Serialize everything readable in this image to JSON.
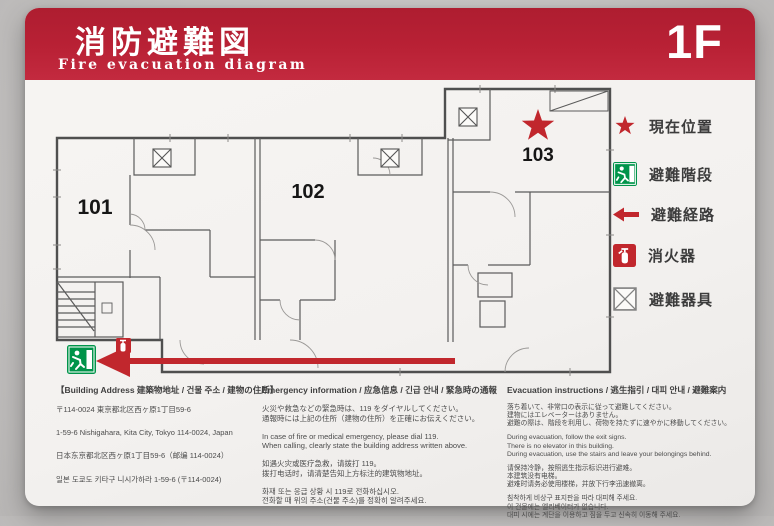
{
  "header": {
    "title_ja": "消防避難図",
    "title_en": "Fire evacuation diagram",
    "floor_label": "1F"
  },
  "floorplan": {
    "rooms": [
      {
        "label": "101"
      },
      {
        "label": "102"
      },
      {
        "label": "103"
      }
    ]
  },
  "legend": {
    "items": [
      {
        "icon": "current-location-star",
        "label": "現在位置"
      },
      {
        "icon": "evacuation-stairs",
        "label": "避難階段"
      },
      {
        "icon": "evacuation-route-arrow",
        "label": "避難経路"
      },
      {
        "icon": "fire-extinguisher",
        "label": "消火器"
      },
      {
        "icon": "evacuation-equipment",
        "label": "避難器具"
      }
    ]
  },
  "sections": {
    "building_address": {
      "heading": "【Building Address 建築物地址 / 건물 주소 / 建物の住所】",
      "lines": [
        "〒114-0024 東京都北区西ヶ原1丁目59-6",
        "1-59-6 Nishigahara, Kita City, Tokyo 114-0024, Japan",
        "日本东京都北区西ヶ原1丁目59-6（邮编 114-0024）",
        "일본 도쿄도 키타구 니시가하라 1-59-6 (〒114-0024)"
      ]
    },
    "emergency_information": {
      "heading": "Emergency information / 应急信息 / 긴급 안내 / 緊急時の通報",
      "paragraphs": [
        [
          "火災や救急などの緊急時は、119 をダイヤルしてください。",
          "通報時には上記の住所（建物の住所）を正確にお伝えください。"
        ],
        [
          "In case of fire or medical emergency, please dial 119.",
          "When calling, clearly state the building address written above."
        ],
        [
          "如遇火灾或医疗急救，请拨打 119。",
          "拨打电话时，请清楚告知上方标注的建筑物地址。"
        ],
        [
          "화재 또는 응급 상황 시 119로 전화하십시오.",
          "전화할 때 위의 주소(건물 주소)를 정확히 알려주세요."
        ]
      ]
    },
    "evacuation_instructions": {
      "heading": "Evacuation instructions / 逃生指引 / 대피 안내 / 避難案内",
      "paragraphs": [
        [
          "落ち着いて、非常口の表示に従って避難してください。",
          "建物にはエレベーターはありません。",
          "避難の際は、階段を利用し、荷物を持たずに速やかに移動してください。"
        ],
        [
          "During evacuation, follow the exit signs.",
          "There is no elevator in this building.",
          "During evacuation, use the stairs and leave your belongings behind."
        ],
        [
          "请保持冷静，按照逃生指示标识进行避难。",
          "本建筑没有电梯。",
          "避难时请务必使用楼梯，并放下行李迅速撤离。"
        ],
        [
          "침착하게 비상구 표지판을 따라 대피해 주세요.",
          "이 건물에는 엘리베이터가 없습니다.",
          "대피 시에는 계단을 이용하고 짐을 두고 신속히 이동해 주세요."
        ]
      ]
    }
  },
  "colors": {
    "header_red": "#b92135",
    "accent_red": "#c1272d",
    "exit_green": "#00944a",
    "panel": "#f5f3f1",
    "wall_background": "#c8c6c5"
  }
}
